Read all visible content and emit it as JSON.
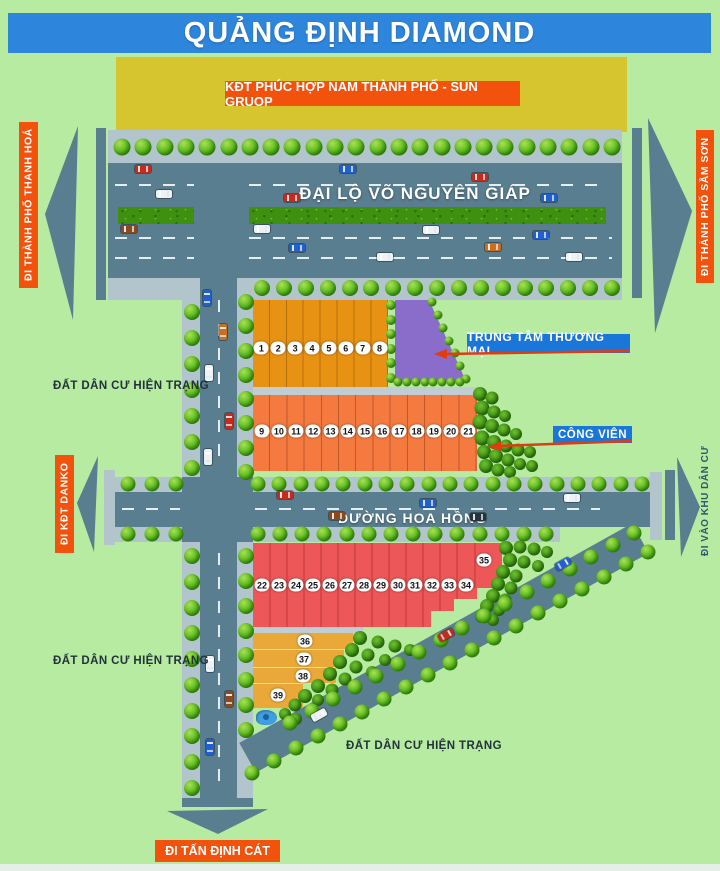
{
  "title": "QUẢNG ĐỊNH DIAMOND",
  "blocks": {
    "kdt_label": "KĐT PHÚC HỢP NAM THÀNH PHỐ - SUN GRUOP"
  },
  "roads": {
    "main_avenue": "ĐẠI LỘ VÕ NGUYÊN GIÁP",
    "rose_street": "ĐƯỜNG HOA HỒNG"
  },
  "directions": {
    "west": "ĐI THÀNH PHỐ THANH HOÁ",
    "east": "ĐI THÀNH PHỐ SẦM SƠN",
    "danko": "ĐI KĐT DANKO",
    "residential": "ĐI VÀO KHU DÂN CƯ",
    "south": "ĐI TẤN ĐỊNH CÁT"
  },
  "pois": {
    "commercial_center": "TRUNG TÂM THƯƠNG MẠI",
    "park": "CÔNG VIÊN"
  },
  "area_labels": [
    "ĐẤT DÂN CƯ HIỆN TRẠNG",
    "ĐẤT DÂN CƯ HIỆN TRẠNG",
    "ĐẤT DÂN CƯ HIỆN TRẠNG"
  ],
  "plots": {
    "row1": [
      1,
      2,
      3,
      4,
      5,
      6,
      7,
      8
    ],
    "row2": [
      9,
      10,
      11,
      12,
      13,
      14,
      15,
      16,
      17,
      18,
      19,
      20,
      21
    ],
    "row3": [
      22,
      23,
      24,
      25,
      26,
      27,
      28,
      29,
      30,
      31,
      32,
      33,
      34
    ],
    "row3_extra": 35,
    "row4": [
      36,
      37,
      38,
      39
    ]
  },
  "colors": {
    "bg": "#b6eba1",
    "road": "#597e8f",
    "sidewalk": "#b2c5cd",
    "titlebar": "#2e86dc",
    "labelblue": "#1b76d9",
    "obanner": "#f2520c",
    "yellow": "#d7c52f",
    "block_a": "#e89214",
    "block_b": "#f47a40",
    "block_c": "#ee5757",
    "block_d": "#e9a838",
    "purple": "#8a6dcb",
    "hedge": "#3f8f10",
    "annotation_red": "#e03c10",
    "pond": "#3f9fe0",
    "areatext": "#22313a",
    "kdctext": "#2d5a6e"
  },
  "vehicles": [
    {
      "c": "#c42b1c",
      "x": 143,
      "y": 169,
      "o": "h"
    },
    {
      "c": "#1f5fd0",
      "x": 348,
      "y": 169,
      "o": "h"
    },
    {
      "c": "#c42b1c",
      "x": 480,
      "y": 177,
      "o": "h"
    },
    {
      "c": "#eef2f4",
      "x": 164,
      "y": 194,
      "o": "h"
    },
    {
      "c": "#c42b1c",
      "x": 292,
      "y": 198,
      "o": "h"
    },
    {
      "c": "#1f5fd0",
      "x": 549,
      "y": 198,
      "o": "h"
    },
    {
      "c": "#8a4a1f",
      "x": 129,
      "y": 229,
      "o": "h"
    },
    {
      "c": "#eef2f4",
      "x": 262,
      "y": 229,
      "o": "h"
    },
    {
      "c": "#eef2f4",
      "x": 431,
      "y": 230,
      "o": "h"
    },
    {
      "c": "#1f5fd0",
      "x": 541,
      "y": 235,
      "o": "h"
    },
    {
      "c": "#1f5fd0",
      "x": 297,
      "y": 248,
      "o": "h"
    },
    {
      "c": "#c96f1e",
      "x": 493,
      "y": 247,
      "o": "h"
    },
    {
      "c": "#eef2f4",
      "x": 385,
      "y": 257,
      "o": "h"
    },
    {
      "c": "#eef2f4",
      "x": 574,
      "y": 257,
      "o": "h"
    },
    {
      "c": "#1f5fd0",
      "x": 207,
      "y": 298,
      "o": "v"
    },
    {
      "c": "#c96f1e",
      "x": 223,
      "y": 332,
      "o": "v"
    },
    {
      "c": "#eef2f4",
      "x": 209,
      "y": 373,
      "o": "v"
    },
    {
      "c": "#c42b1c",
      "x": 229,
      "y": 421,
      "o": "v"
    },
    {
      "c": "#eef2f4",
      "x": 208,
      "y": 457,
      "o": "v"
    },
    {
      "c": "#c42b1c",
      "x": 285,
      "y": 495,
      "o": "h"
    },
    {
      "c": "#8a4a1f",
      "x": 337,
      "y": 516,
      "o": "h"
    },
    {
      "c": "#1f5fd0",
      "x": 428,
      "y": 503,
      "o": "h"
    },
    {
      "c": "#26343c",
      "x": 478,
      "y": 517,
      "o": "h"
    },
    {
      "c": "#eef2f4",
      "x": 572,
      "y": 498,
      "o": "h"
    },
    {
      "c": "#eef2f4",
      "x": 210,
      "y": 664,
      "o": "v"
    },
    {
      "c": "#8a4a1f",
      "x": 229,
      "y": 699,
      "o": "v"
    },
    {
      "c": "#1f5fd0",
      "x": 210,
      "y": 747,
      "o": "v"
    },
    {
      "c": "#1f5fd0",
      "x": 563,
      "y": 564,
      "o": "d"
    },
    {
      "c": "#c42b1c",
      "x": 446,
      "y": 635,
      "o": "d"
    },
    {
      "c": "#eef2f4",
      "x": 319,
      "y": 715,
      "o": "d"
    }
  ]
}
